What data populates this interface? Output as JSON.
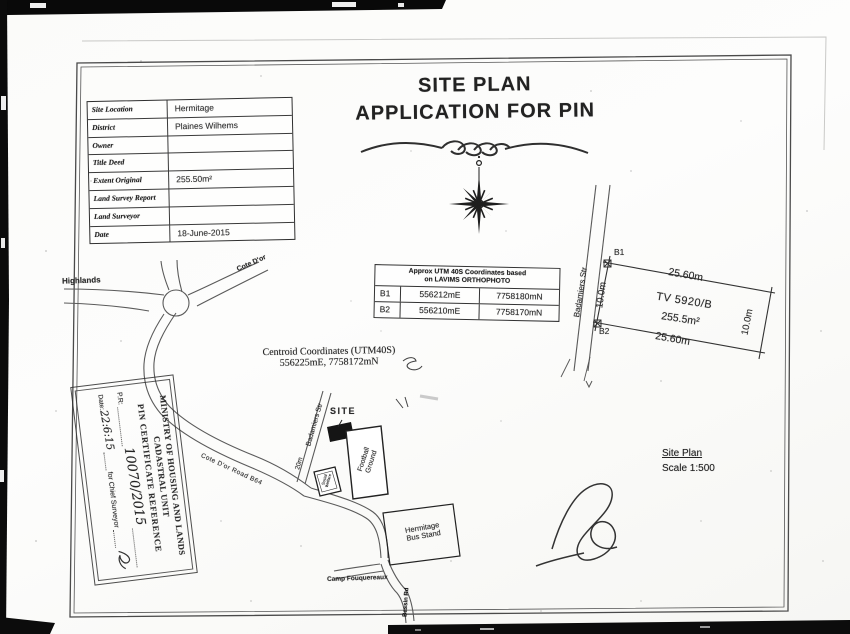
{
  "document": {
    "title_line1": "SITE PLAN",
    "title_line2": "APPLICATION FOR PIN"
  },
  "info_table": {
    "rows": [
      {
        "label": "Site Location",
        "value": "Hermitage"
      },
      {
        "label": "District",
        "value": "Plaines Wilhems"
      },
      {
        "label": "Owner",
        "value": ""
      },
      {
        "label": "Title Deed",
        "value": ""
      },
      {
        "label": "Extent Original",
        "value": "255.50m²"
      },
      {
        "label": "Land Survey Report",
        "value": ""
      },
      {
        "label": "Land Surveyor",
        "value": ""
      },
      {
        "label": "Date",
        "value": "18-June-2015"
      }
    ]
  },
  "utm_table": {
    "header_line1": "Approx UTM 40S Coordinates based",
    "header_line2": "on LAVIMS ORTHOPHOTO",
    "rows": [
      {
        "point": "B1",
        "easting": "556212mE",
        "northing": "7758180mN"
      },
      {
        "point": "B2",
        "easting": "556210mE",
        "northing": "7758170mN"
      }
    ]
  },
  "centroid": {
    "line1": "Centroid Coordinates (UTM40S)",
    "line2": "556225mE, 7758172mN"
  },
  "plot": {
    "b1": "B1",
    "b2": "B2",
    "street": "Badamiers Str",
    "dim_top": "25.60m",
    "dim_bottom": "25.60m",
    "dim_left": "10.0m",
    "dim_right": "10.0m",
    "parcel_id": "TV 5920/B",
    "area": "255.5m²"
  },
  "map": {
    "highlands": "Highlands",
    "cote_dor": "Cote D'or",
    "badamiers_str": "Badamiers Str",
    "road_width": "20m",
    "site": "SITE",
    "football_line1": "Football",
    "football_line2": "Ground",
    "building_line1": "Social",
    "building_line2": "Welfare",
    "bus_stand_line1": "Hermitage",
    "bus_stand_line2": "Bus Stand",
    "camp_fouquereaux": "Camp Fouquereaux",
    "road_b64": "Cote D'or Road B64",
    "south_road": "Bassin Rd"
  },
  "stamp": {
    "ministry": "MINISTRY OF HOUSING AND LANDS",
    "unit": "CADASTRAL UNIT",
    "reference": "PIN CERTIFICATE REFERENCE",
    "pr_label": "P.R:",
    "pr_value": "10070/2015",
    "date_label": "Date:",
    "date_value": "22:6:15",
    "for_label": "for Chief Surveyor"
  },
  "scale_note": {
    "line1": "Site Plan",
    "line2": "Scale 1:500"
  }
}
